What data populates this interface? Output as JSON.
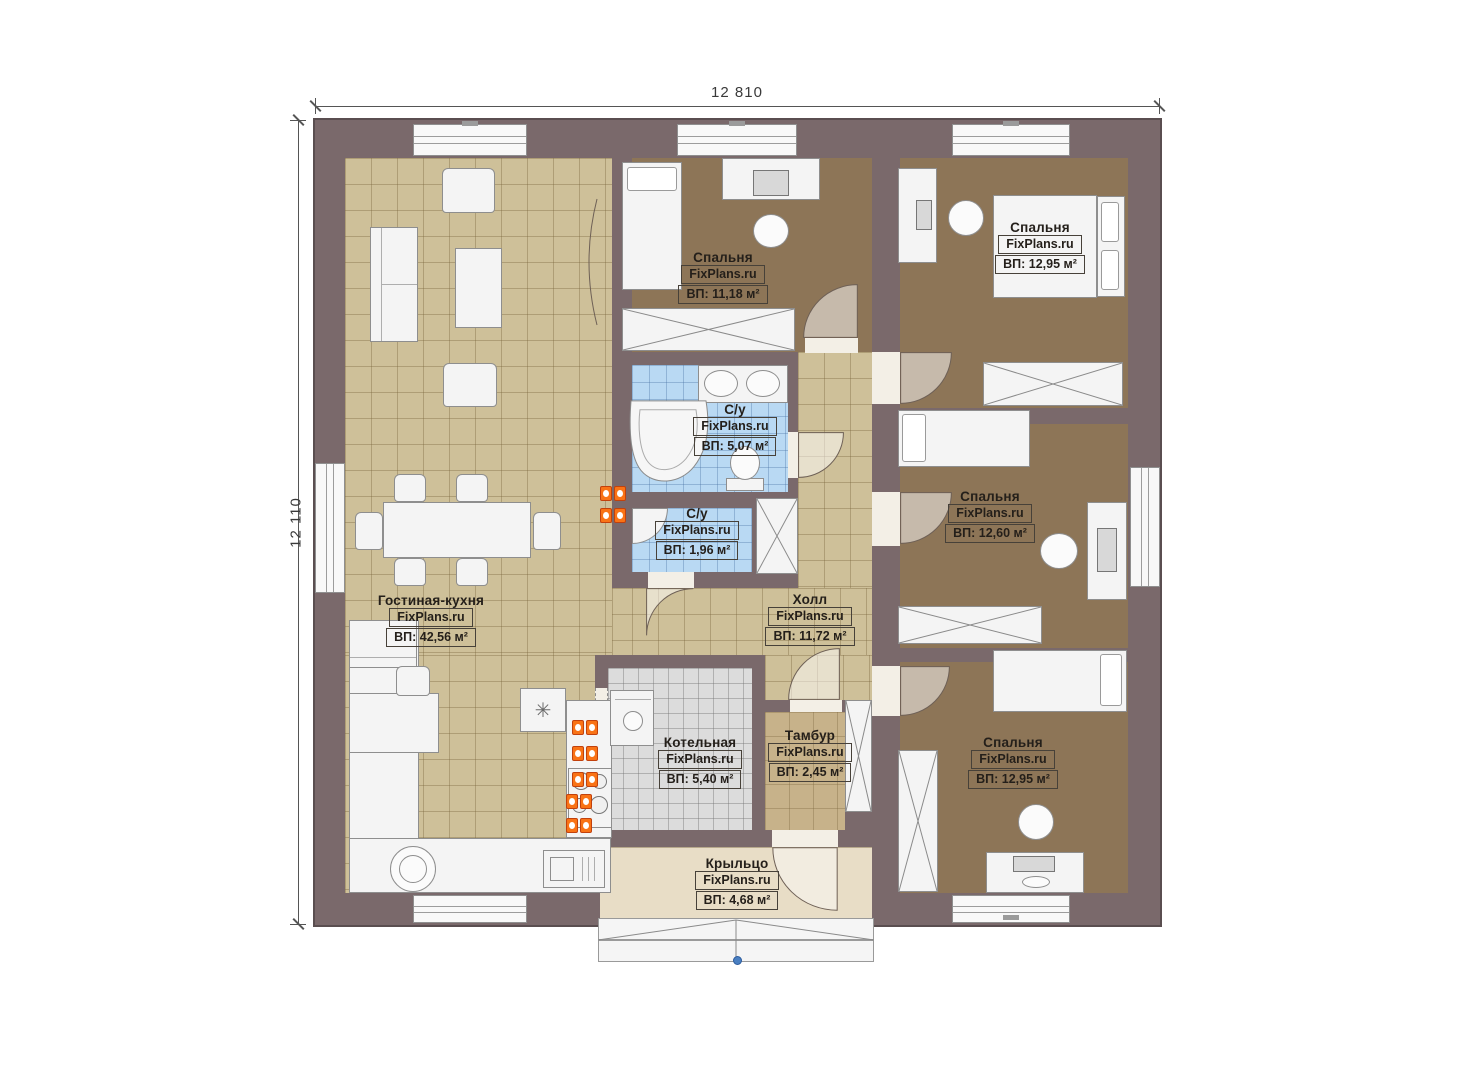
{
  "plan": {
    "brand": "FixPlans.ru",
    "dimensions": {
      "width": "12 810",
      "height": "12 110"
    },
    "rooms": {
      "living": {
        "name": "Гостиная-кухня",
        "area": "ВП: 42,56 м²"
      },
      "bedroom_top": {
        "name": "Спальня",
        "area": "ВП: 11,18 м²"
      },
      "bedroom_top_right": {
        "name": "Спальня",
        "area": "ВП: 12,95 м²"
      },
      "bath_main": {
        "name": "С/у",
        "area": "ВП: 5,07 м²"
      },
      "bath_small": {
        "name": "С/у",
        "area": "ВП: 1,96 м²"
      },
      "bedroom_right": {
        "name": "Спальня",
        "area": "ВП: 12,60 м²"
      },
      "hall": {
        "name": "Холл",
        "area": "ВП: 11,72 м²"
      },
      "boiler": {
        "name": "Котельная",
        "area": "ВП: 5,40 м²"
      },
      "vestibule": {
        "name": "Тамбур",
        "area": "ВП: 2,45 м²"
      },
      "bedroom_bottom_right": {
        "name": "Спальня",
        "area": "ВП: 12,95 м²"
      },
      "porch": {
        "name": "Крыльцо",
        "area": "ВП: 4,68 м²"
      }
    },
    "colors": {
      "wall": "#7a696b",
      "floor_tile": "#cec099",
      "bedroom_floor": "#8d7557",
      "bath_floor": "#b9d9f3",
      "boiler_floor": "#dcdcdc",
      "porch_floor": "#e8ddc6",
      "radiator": "#f97316",
      "survey_point": "#4a7fc1"
    }
  }
}
